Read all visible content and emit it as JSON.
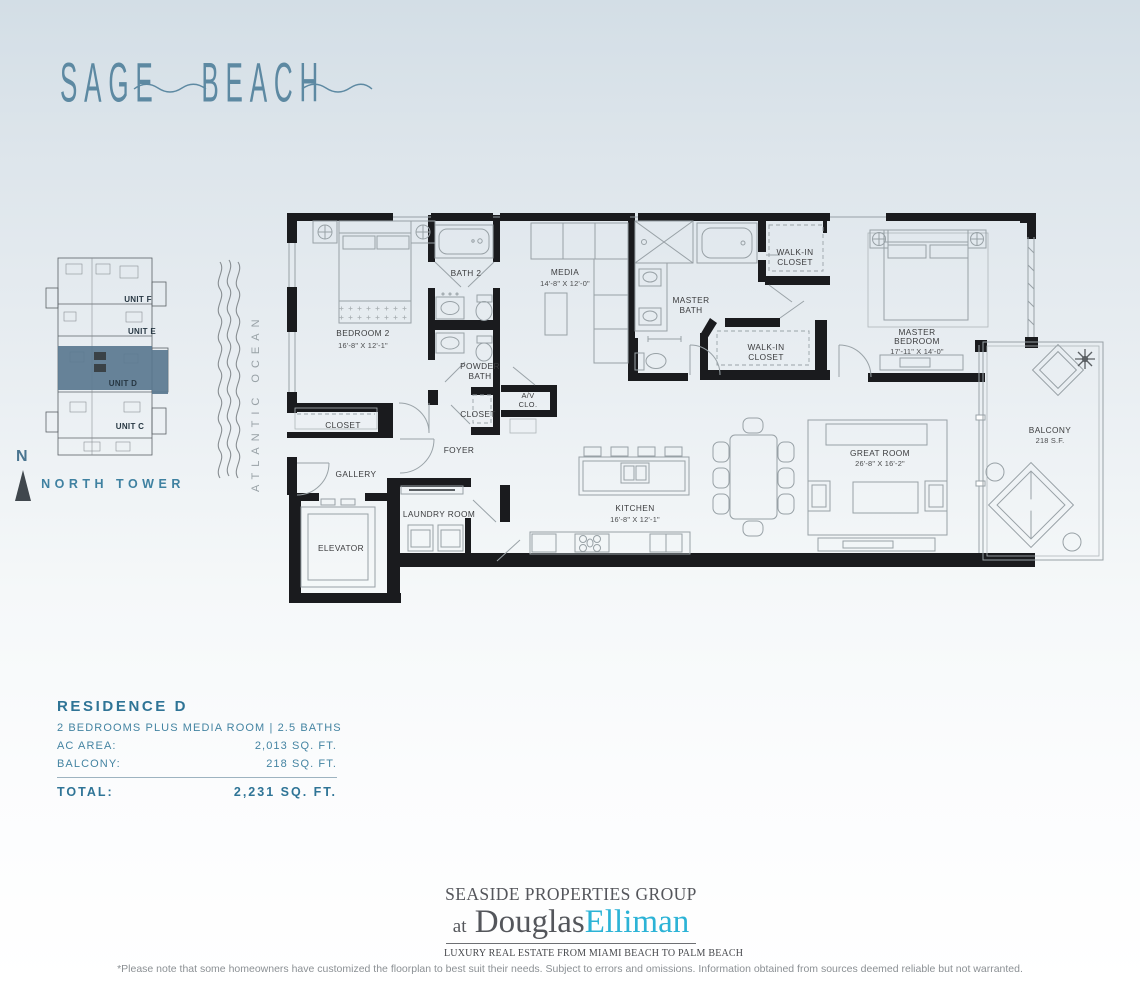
{
  "logo": {
    "word1": "SAGE",
    "word2": "BEACH",
    "color": "#5d89a2"
  },
  "keyplan": {
    "units": [
      {
        "label": "UNIT F"
      },
      {
        "label": "UNIT E"
      },
      {
        "label": "UNIT D"
      },
      {
        "label": "UNIT C"
      }
    ],
    "highlighted_unit": "UNIT D",
    "highlight_color": "#5a7890",
    "tower_label": "NORTH TOWER",
    "compass": "N"
  },
  "ocean": {
    "label": "ATLANTIC OCEAN"
  },
  "floorplan": {
    "rooms": {
      "bedroom2": {
        "name": "BEDROOM 2",
        "dims": "16'-8\" X 12'-1\""
      },
      "bath2": {
        "name": "BATH 2"
      },
      "media": {
        "name": "MEDIA",
        "dims": "14'-8\" X 12'-0\""
      },
      "powder_bath": {
        "line1": "POWDER",
        "line2": "BATH"
      },
      "closet_hall": {
        "name": "CLOSET"
      },
      "av_closet": {
        "line1": "A/V",
        "line2": "CLO."
      },
      "closet_bedroom2": {
        "name": "CLOSET"
      },
      "foyer": {
        "name": "FOYER"
      },
      "gallery": {
        "name": "GALLERY"
      },
      "elevator": {
        "name": "ELEVATOR"
      },
      "laundry": {
        "name": "LAUNDRY ROOM"
      },
      "kitchen": {
        "name": "KITCHEN",
        "dims": "16'-8\" X 12'-1\""
      },
      "master_bath": {
        "line1": "MASTER",
        "line2": "BATH"
      },
      "walk_in_closet_1": {
        "line1": "WALK-IN",
        "line2": "CLOSET"
      },
      "walk_in_closet_2": {
        "line1": "WALK-IN",
        "line2": "CLOSET"
      },
      "master_bedroom": {
        "line1": "MASTER",
        "line2": "BEDROOM",
        "dims": "17'-11\" X 14'-0\""
      },
      "great_room": {
        "name": "GREAT ROOM",
        "dims": "26'-8\" X 16'-2\""
      },
      "balcony": {
        "name": "BALCONY",
        "dims": "218 S.F."
      }
    }
  },
  "residence": {
    "title": "RESIDENCE D",
    "subtitle": "2 BEDROOMS PLUS MEDIA ROOM | 2.5 BATHS",
    "rows": [
      {
        "label": "AC AREA:",
        "value": "2,013 SQ. FT."
      },
      {
        "label": "BALCONY:",
        "value": "218 SQ. FT."
      }
    ],
    "total_label": "TOTAL:",
    "total_value": "2,231 SQ. FT."
  },
  "branding": {
    "group": "SEASIDE PROPERTIES GROUP",
    "at": "at",
    "brand_dark": "Douglas",
    "brand_light": "Elliman",
    "tagline": "LUXURY REAL ESTATE FROM MIAMI BEACH TO PALM BEACH",
    "accent_color": "#2cb3d6"
  },
  "disclaimer": "*Please note that some homeowners have customized the floorplan to best suit their needs. Subject to errors and omissions. Information obtained from sources deemed reliable but not warranted.",
  "colors": {
    "accent_teal": "#3c7fa0",
    "background_top": "#d3dee6",
    "plan_walls": "#1a1b1e",
    "brand_cyan": "#2cb3d6",
    "unit_highlight": "#5a7890"
  }
}
